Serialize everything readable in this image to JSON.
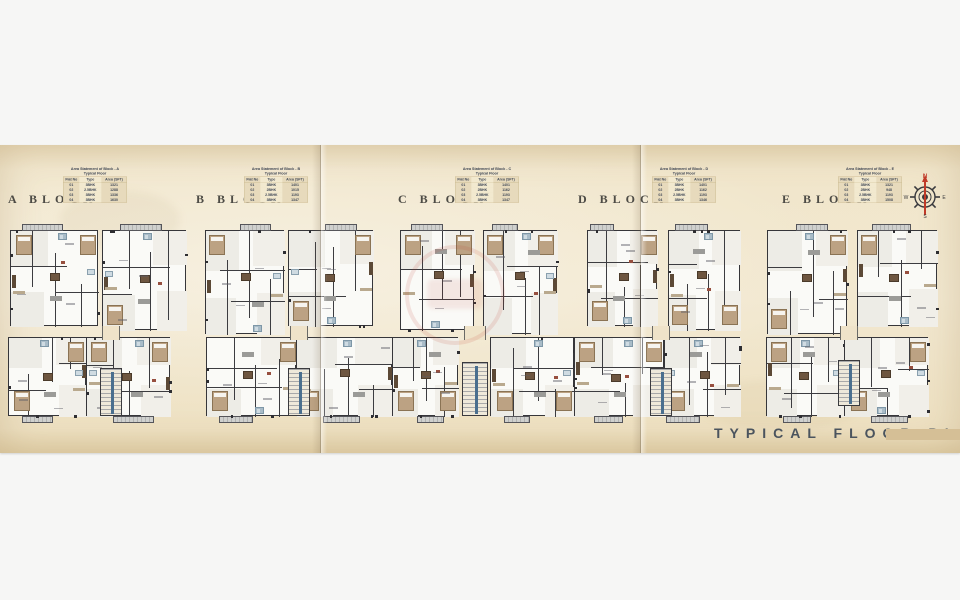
{
  "page": {
    "background": "#f6f6f5",
    "paper_color": "#f2e8d0"
  },
  "footer": {
    "title": "TYPICAL FLOOR PLAN",
    "bar_color": "#d5bf96"
  },
  "compass": {
    "north": "N",
    "east": "E",
    "south": "S",
    "west": "W",
    "needle_color": "#c03a28",
    "ring_color": "#3a3a3e"
  },
  "table_meta": {
    "title_prefix": "Area Statement of Block - ",
    "subtitle": "Typical Floor",
    "headers": [
      "Flat No",
      "Type",
      "Area (SFT)"
    ]
  },
  "blocks": [
    {
      "label": "A BLOCK",
      "letter": "A",
      "rows": [
        [
          "01",
          "3BHK",
          "1321"
        ],
        [
          "02",
          "2.5BHK",
          "1288"
        ],
        [
          "03",
          "3BHK",
          "1336"
        ],
        [
          "04",
          "3BHK",
          "1630"
        ]
      ]
    },
    {
      "label": "B BLOCK",
      "letter": "B",
      "rows": [
        [
          "01",
          "3BHK",
          "1401"
        ],
        [
          "02",
          "2BHK",
          "1015"
        ],
        [
          "03",
          "2.5BHK",
          "1193"
        ],
        [
          "04",
          "3BHK",
          "1347"
        ]
      ]
    },
    {
      "label": "C BLOCK",
      "letter": "C",
      "rows": [
        [
          "01",
          "3BHK",
          "1401"
        ],
        [
          "02",
          "2BHK",
          "1162"
        ],
        [
          "03",
          "2.5BHK",
          "1193"
        ],
        [
          "04",
          "3BHK",
          "1347"
        ]
      ]
    },
    {
      "label": "D BLOCK",
      "letter": "D",
      "rows": [
        [
          "01",
          "3BHK",
          "1401"
        ],
        [
          "02",
          "2BHK",
          "1162"
        ],
        [
          "03",
          "2.5BHK",
          "1193"
        ],
        [
          "04",
          "3BHK",
          "1346"
        ]
      ]
    },
    {
      "label": "E BLOCK",
      "letter": "E",
      "rows": [
        [
          "01",
          "3BHK",
          "1321"
        ],
        [
          "02",
          "2BHK",
          "948"
        ],
        [
          "03",
          "2.5BHK",
          "1193"
        ],
        [
          "04",
          "3BHK",
          "1508"
        ]
      ]
    }
  ],
  "plan_palette": {
    "wall": "#36363a",
    "floor": "#fafaf7",
    "room_fill": "#edece6",
    "bed_tan": "#bca283",
    "wood_dark": "#5c4936",
    "wood_mid": "#6e5640",
    "counter": "#b9a98e",
    "sofa_gray": "#9b9b98",
    "bath_blue": "#a9bcc8",
    "bath_light": "#cfdbe2",
    "accent_red": "#974f3f",
    "balcony_gray": "#cfd0ce"
  }
}
